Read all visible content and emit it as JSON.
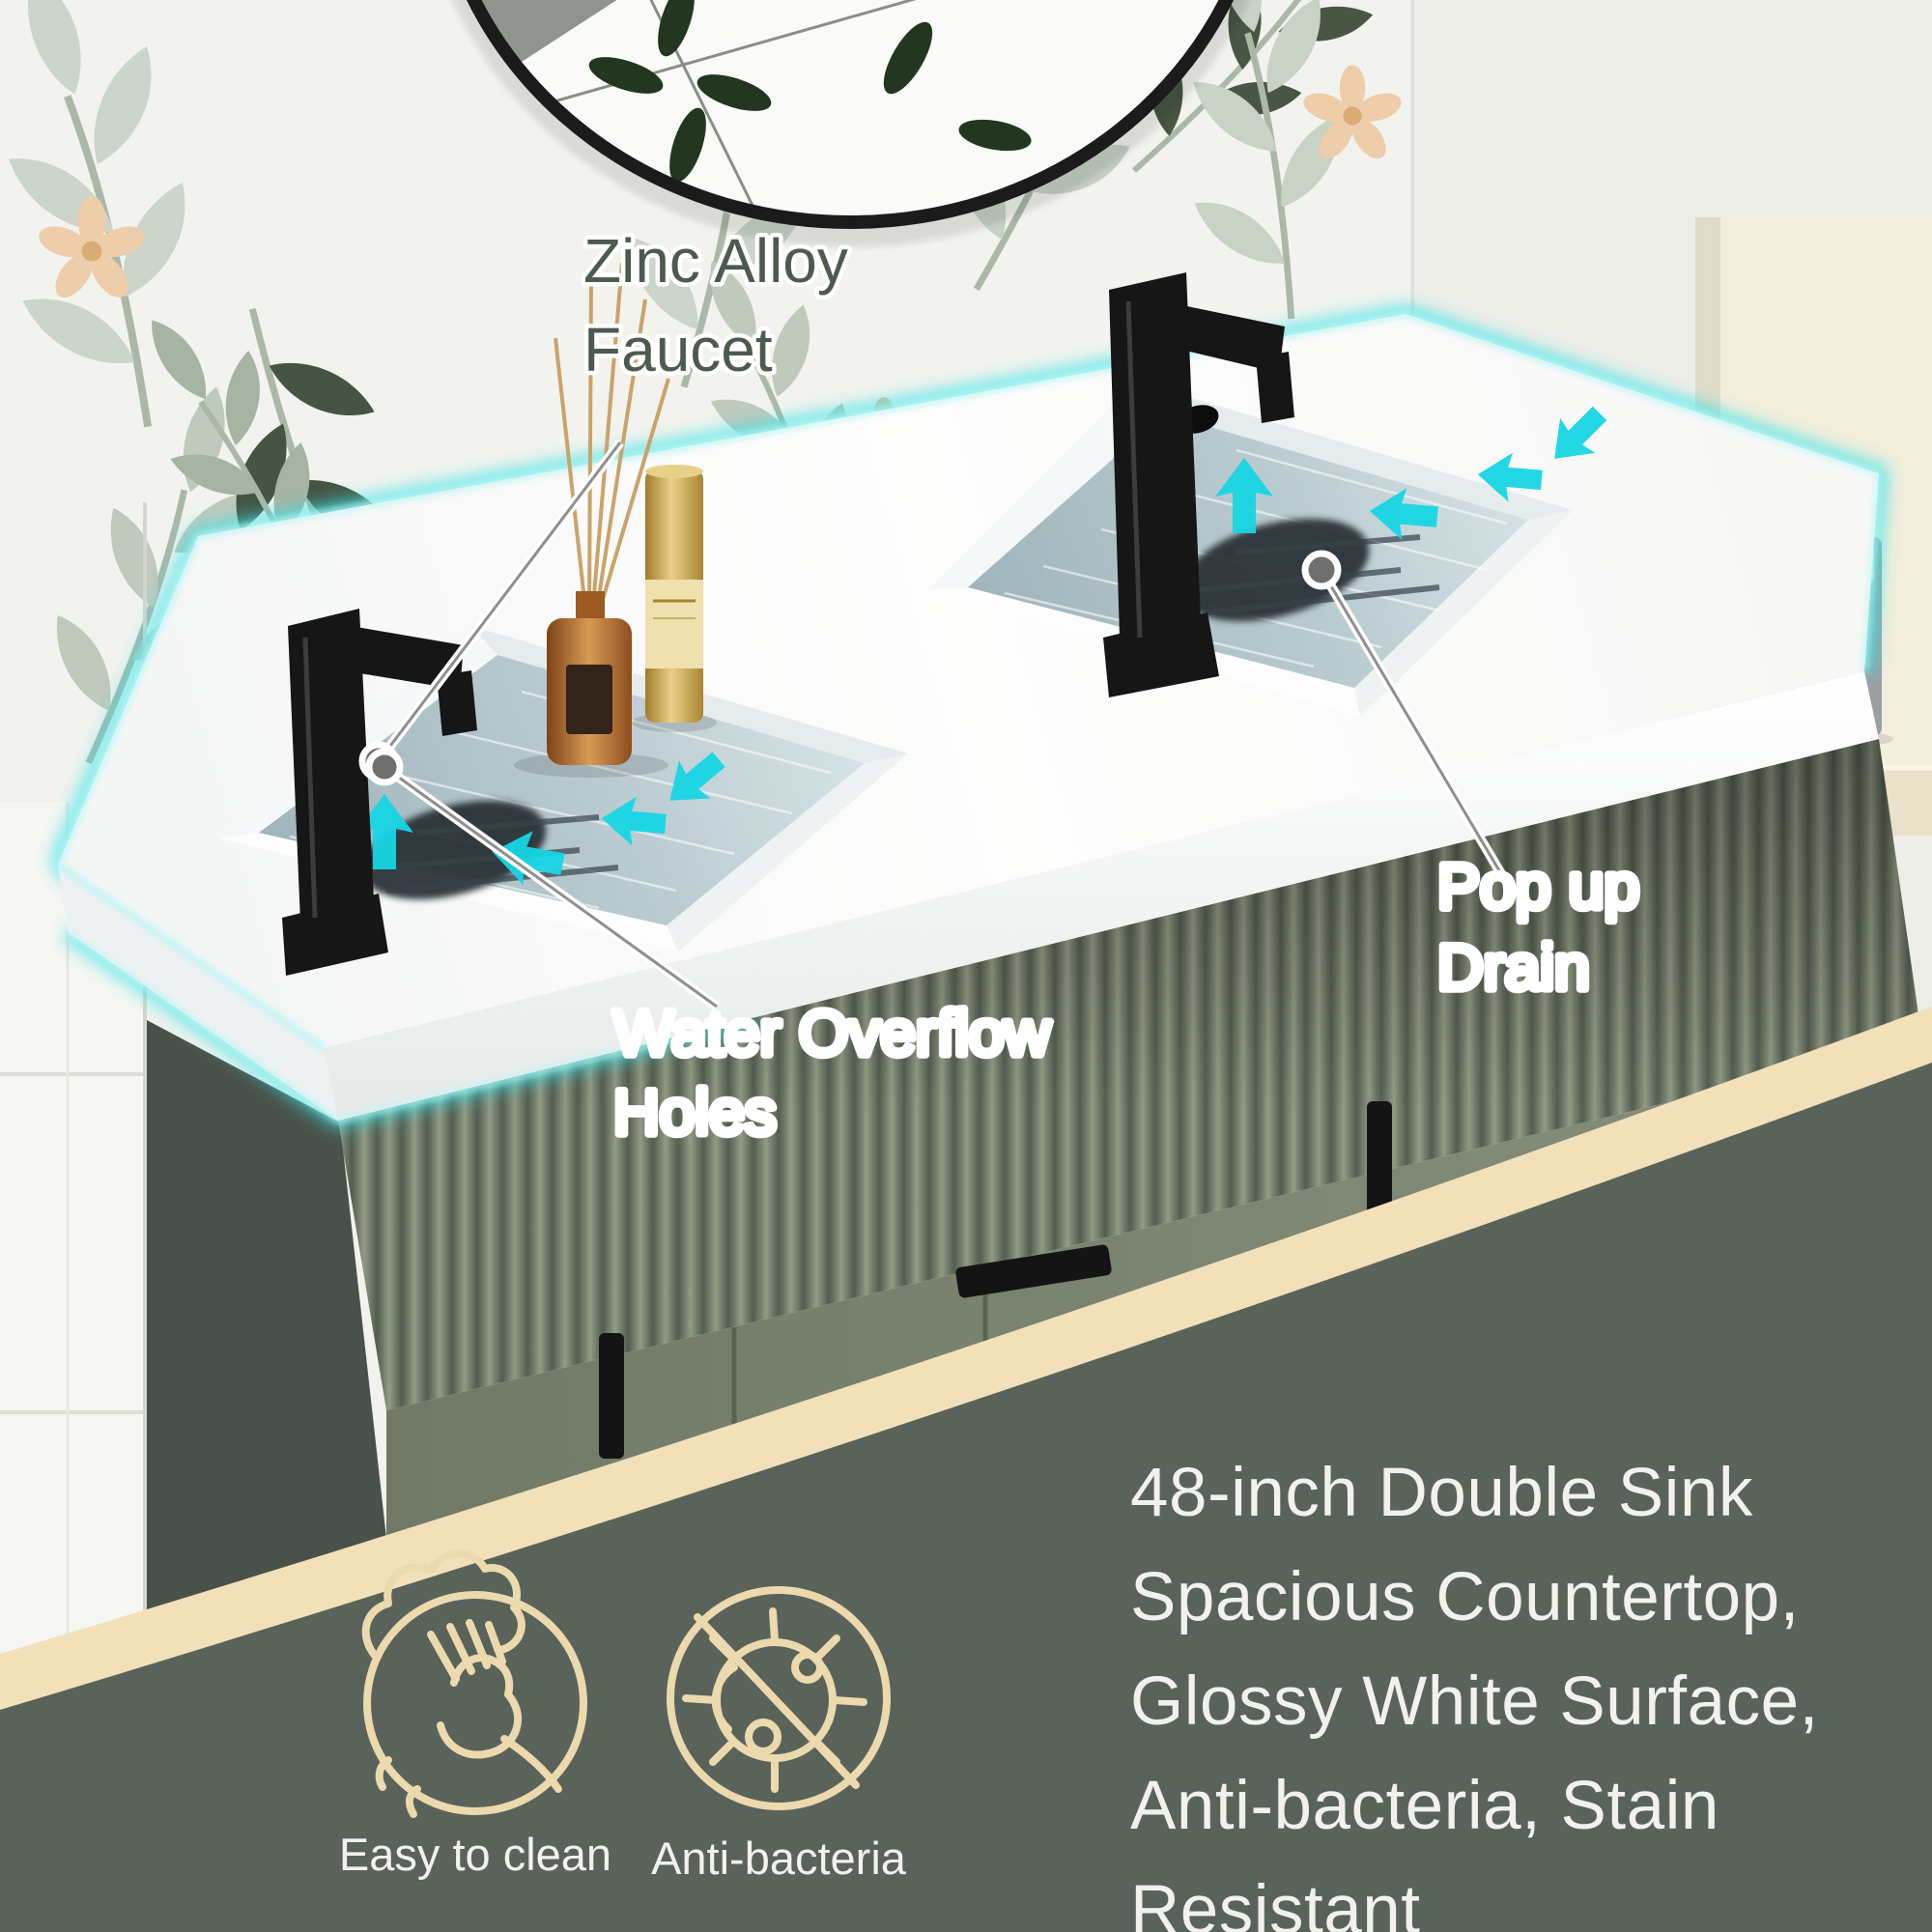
{
  "callouts": {
    "faucet": {
      "line1": "Zinc Alloy",
      "line2": "Faucet"
    },
    "overflow": {
      "line1": "Water Overflow",
      "line2": "Holes"
    },
    "drain": {
      "line1": "Pop up",
      "line2": "Drain"
    }
  },
  "product": {
    "feature_lines": [
      "48-inch Double Sink",
      "Spacious Countertop,",
      "Glossy White Surface,",
      "Anti-bacteria, Stain",
      "Resistant"
    ]
  },
  "badges": [
    {
      "icon": "wipe-clean-icon",
      "label": "Easy to clean"
    },
    {
      "icon": "anti-bacteria-icon",
      "label": "Anti-bacteria"
    }
  ],
  "decor": {
    "candle_label": "meraki"
  },
  "colors": {
    "led_glow": "#35e3e8",
    "water": "#b5c8cd",
    "cabinet_sage": "#7d8773",
    "overlay_green": "#59635a",
    "band_beige": "#f2e0b8",
    "icon_line": "#ecd9ae",
    "callout_green": "#4d5a4e",
    "faucet_black": "#161616"
  }
}
